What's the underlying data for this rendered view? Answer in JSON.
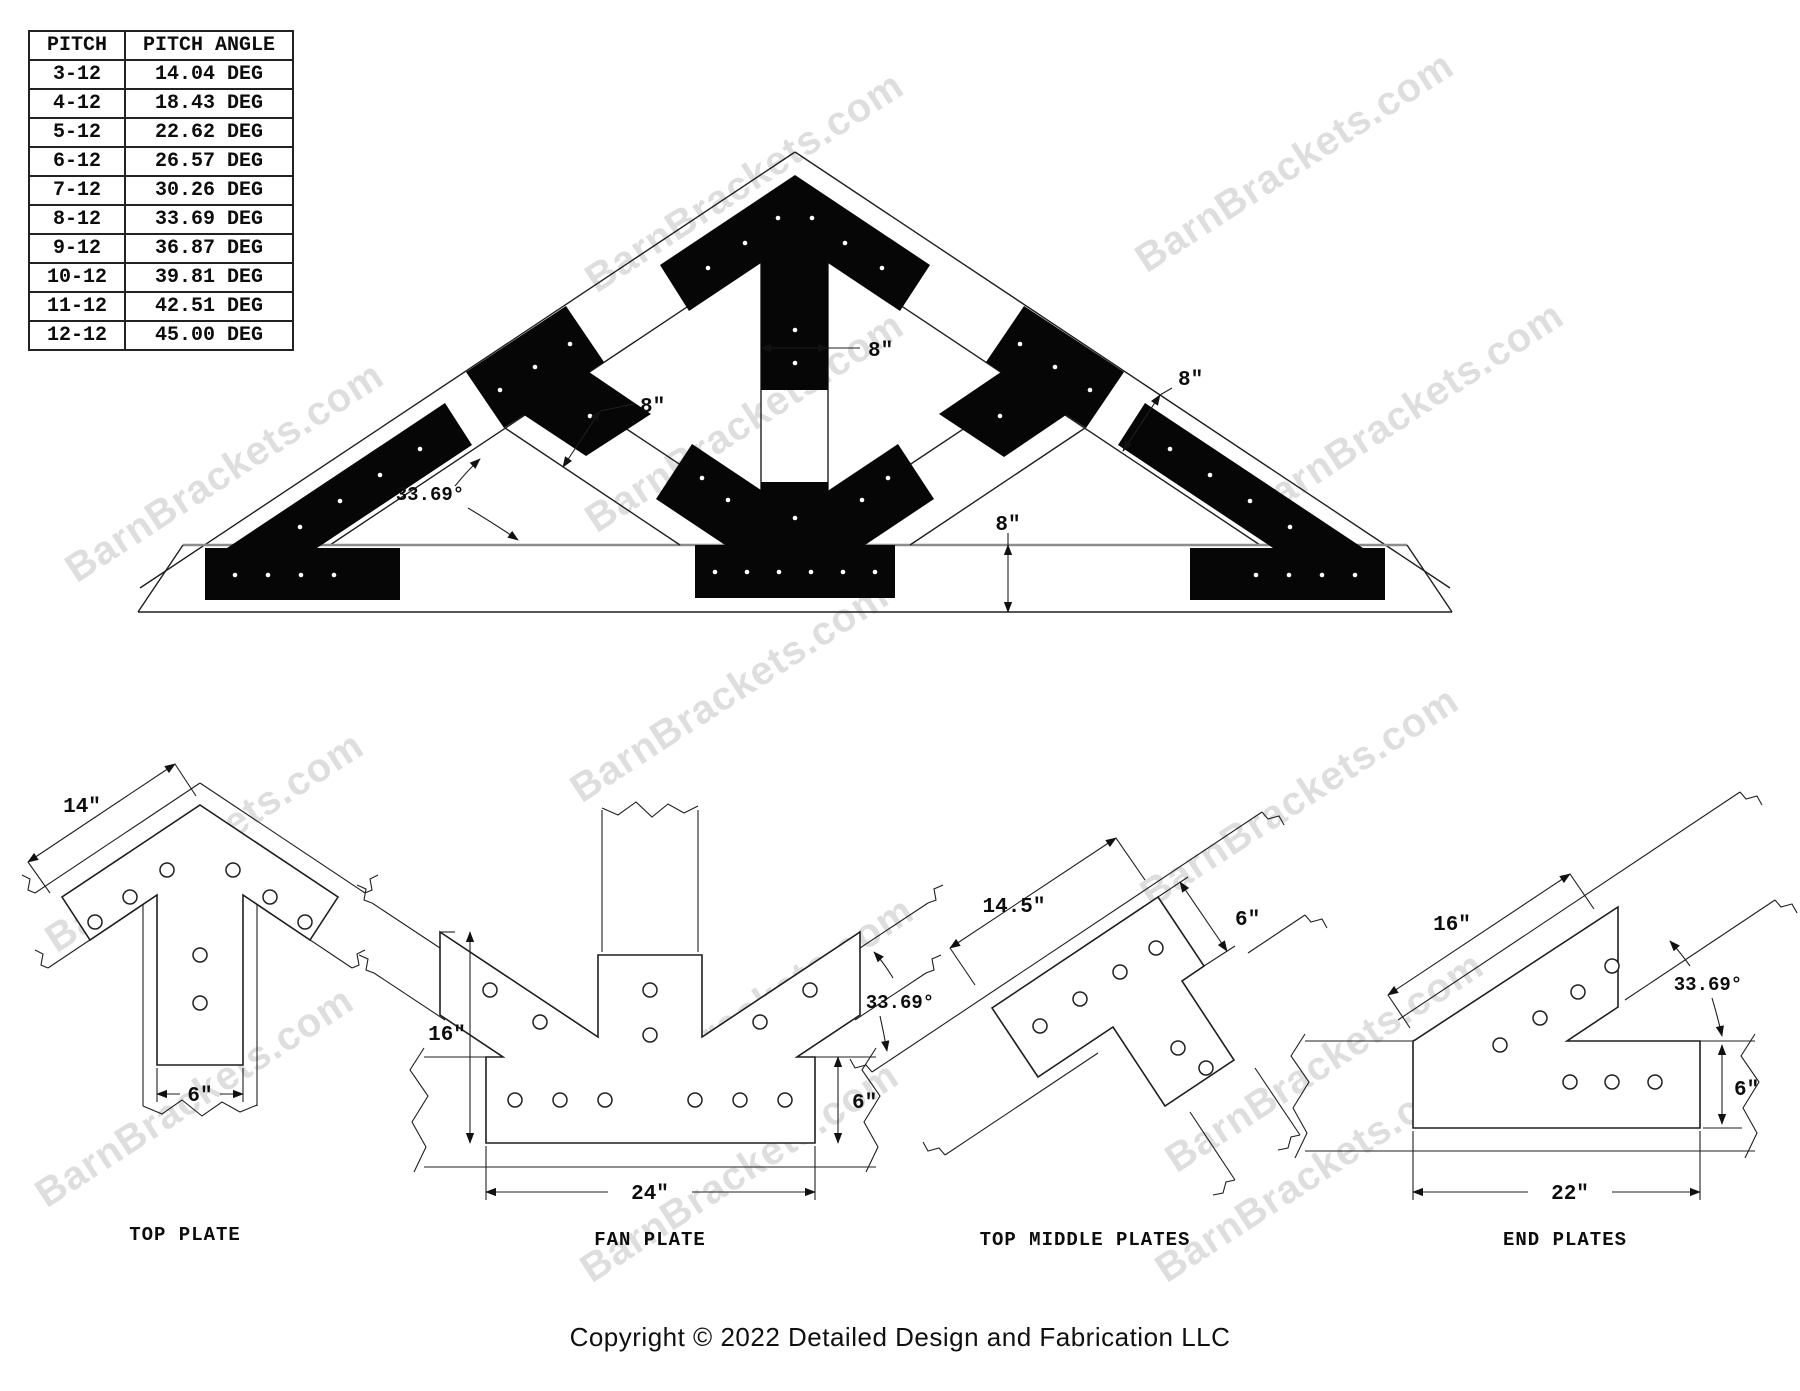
{
  "watermark": {
    "text": "BarnBrackets.com"
  },
  "pitch_table": {
    "headers": [
      "PITCH",
      "PITCH ANGLE"
    ],
    "rows": [
      [
        "3-12",
        "14.04 DEG"
      ],
      [
        "4-12",
        "18.43 DEG"
      ],
      [
        "5-12",
        "22.62 DEG"
      ],
      [
        "6-12",
        "26.57 DEG"
      ],
      [
        "7-12",
        "30.26 DEG"
      ],
      [
        "8-12",
        "33.69 DEG"
      ],
      [
        "9-12",
        "36.87 DEG"
      ],
      [
        "10-12",
        "39.81 DEG"
      ],
      [
        "11-12",
        "42.51 DEG"
      ],
      [
        "12-12",
        "45.00 DEG"
      ]
    ]
  },
  "truss": {
    "dim_8": "8\"",
    "angle": "33.69°"
  },
  "details": {
    "top_plate": {
      "label": "TOP PLATE",
      "dim_width": "14\"",
      "dim_leg": "6\""
    },
    "fan_plate": {
      "label": "FAN PLATE",
      "dim_height": "16\"",
      "dim_width": "24\"",
      "dim_thick": "6\"",
      "angle": "33.69°"
    },
    "top_middle": {
      "label": "TOP MIDDLE PLATES",
      "dim_length": "14.5\"",
      "dim_width": "6\""
    },
    "end_plates": {
      "label": "END PLATES",
      "dim_length": "16\"",
      "dim_width": "6\"",
      "dim_base": "22\"",
      "angle": "33.69°"
    }
  },
  "footer": {
    "copyright": "Copyright © 2022 Detailed Design and Fabrication LLC"
  }
}
